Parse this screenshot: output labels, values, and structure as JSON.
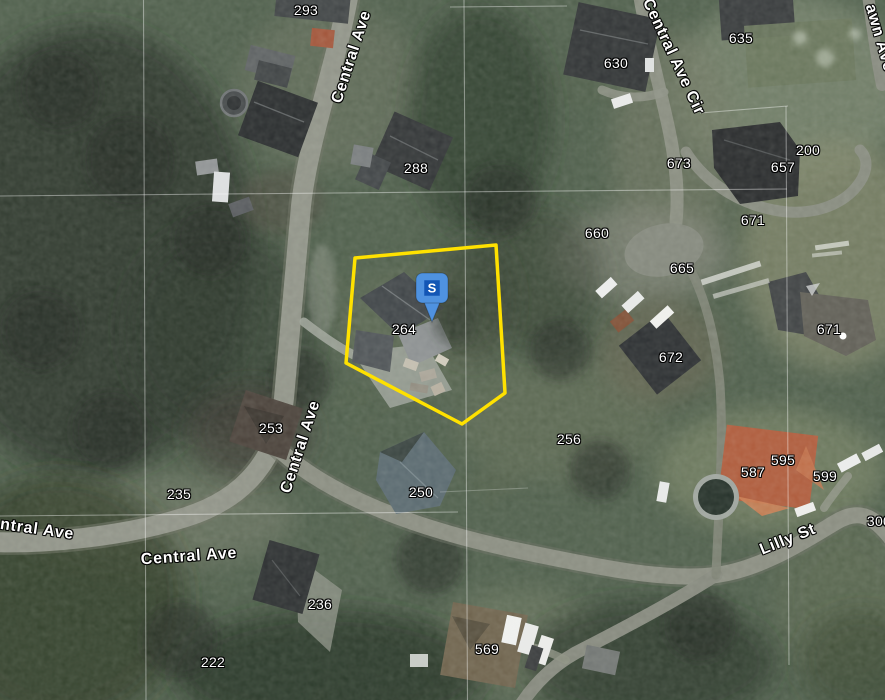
{
  "map": {
    "view_type": "satellite",
    "parcel": {
      "address": "264",
      "color": "#ffe100",
      "points": "355,258 496,245 505,393 462,424 346,363"
    },
    "marker": {
      "label": "S",
      "x": 432,
      "y": 322,
      "color": "#4f92e0",
      "inner_color": "#1356b5"
    },
    "address_labels": [
      {
        "text": "293",
        "x": 306,
        "y": 10
      },
      {
        "text": "288",
        "x": 416,
        "y": 168
      },
      {
        "text": "635",
        "x": 741,
        "y": 38
      },
      {
        "text": "630",
        "x": 616,
        "y": 63
      },
      {
        "text": "200",
        "x": 808,
        "y": 150
      },
      {
        "text": "657",
        "x": 783,
        "y": 167
      },
      {
        "text": "673",
        "x": 679,
        "y": 163
      },
      {
        "text": "671",
        "x": 753,
        "y": 220
      },
      {
        "text": "660",
        "x": 597,
        "y": 233
      },
      {
        "text": "665",
        "x": 682,
        "y": 268
      },
      {
        "text": "671",
        "x": 829,
        "y": 329
      },
      {
        "text": "264",
        "x": 404,
        "y": 329
      },
      {
        "text": "672",
        "x": 671,
        "y": 357
      },
      {
        "text": "253",
        "x": 271,
        "y": 428
      },
      {
        "text": "256",
        "x": 569,
        "y": 439
      },
      {
        "text": "235",
        "x": 179,
        "y": 494
      },
      {
        "text": "250",
        "x": 421,
        "y": 492
      },
      {
        "text": "595",
        "x": 783,
        "y": 460
      },
      {
        "text": "587",
        "x": 753,
        "y": 472
      },
      {
        "text": "599",
        "x": 825,
        "y": 476
      },
      {
        "text": "300",
        "x": 879,
        "y": 521
      },
      {
        "text": "236",
        "x": 320,
        "y": 604
      },
      {
        "text": "569",
        "x": 487,
        "y": 649
      },
      {
        "text": "222",
        "x": 213,
        "y": 662
      }
    ],
    "street_labels": [
      {
        "text": "Central Ave",
        "x": 352,
        "y": 57,
        "rot": -72
      },
      {
        "text": "Central Ave Cir",
        "x": 673,
        "y": 57,
        "rot": 65
      },
      {
        "text": "awn Ave",
        "x": 879,
        "y": 38,
        "rot": 74
      },
      {
        "text": "Central Ave",
        "x": 301,
        "y": 447,
        "rot": -72
      },
      {
        "text": "ntral Ave",
        "x": 37,
        "y": 530,
        "rot": 8
      },
      {
        "text": "Central Ave",
        "x": 189,
        "y": 557,
        "rot": -4
      },
      {
        "text": "Lilly St",
        "x": 788,
        "y": 540,
        "rot": -22
      }
    ]
  }
}
